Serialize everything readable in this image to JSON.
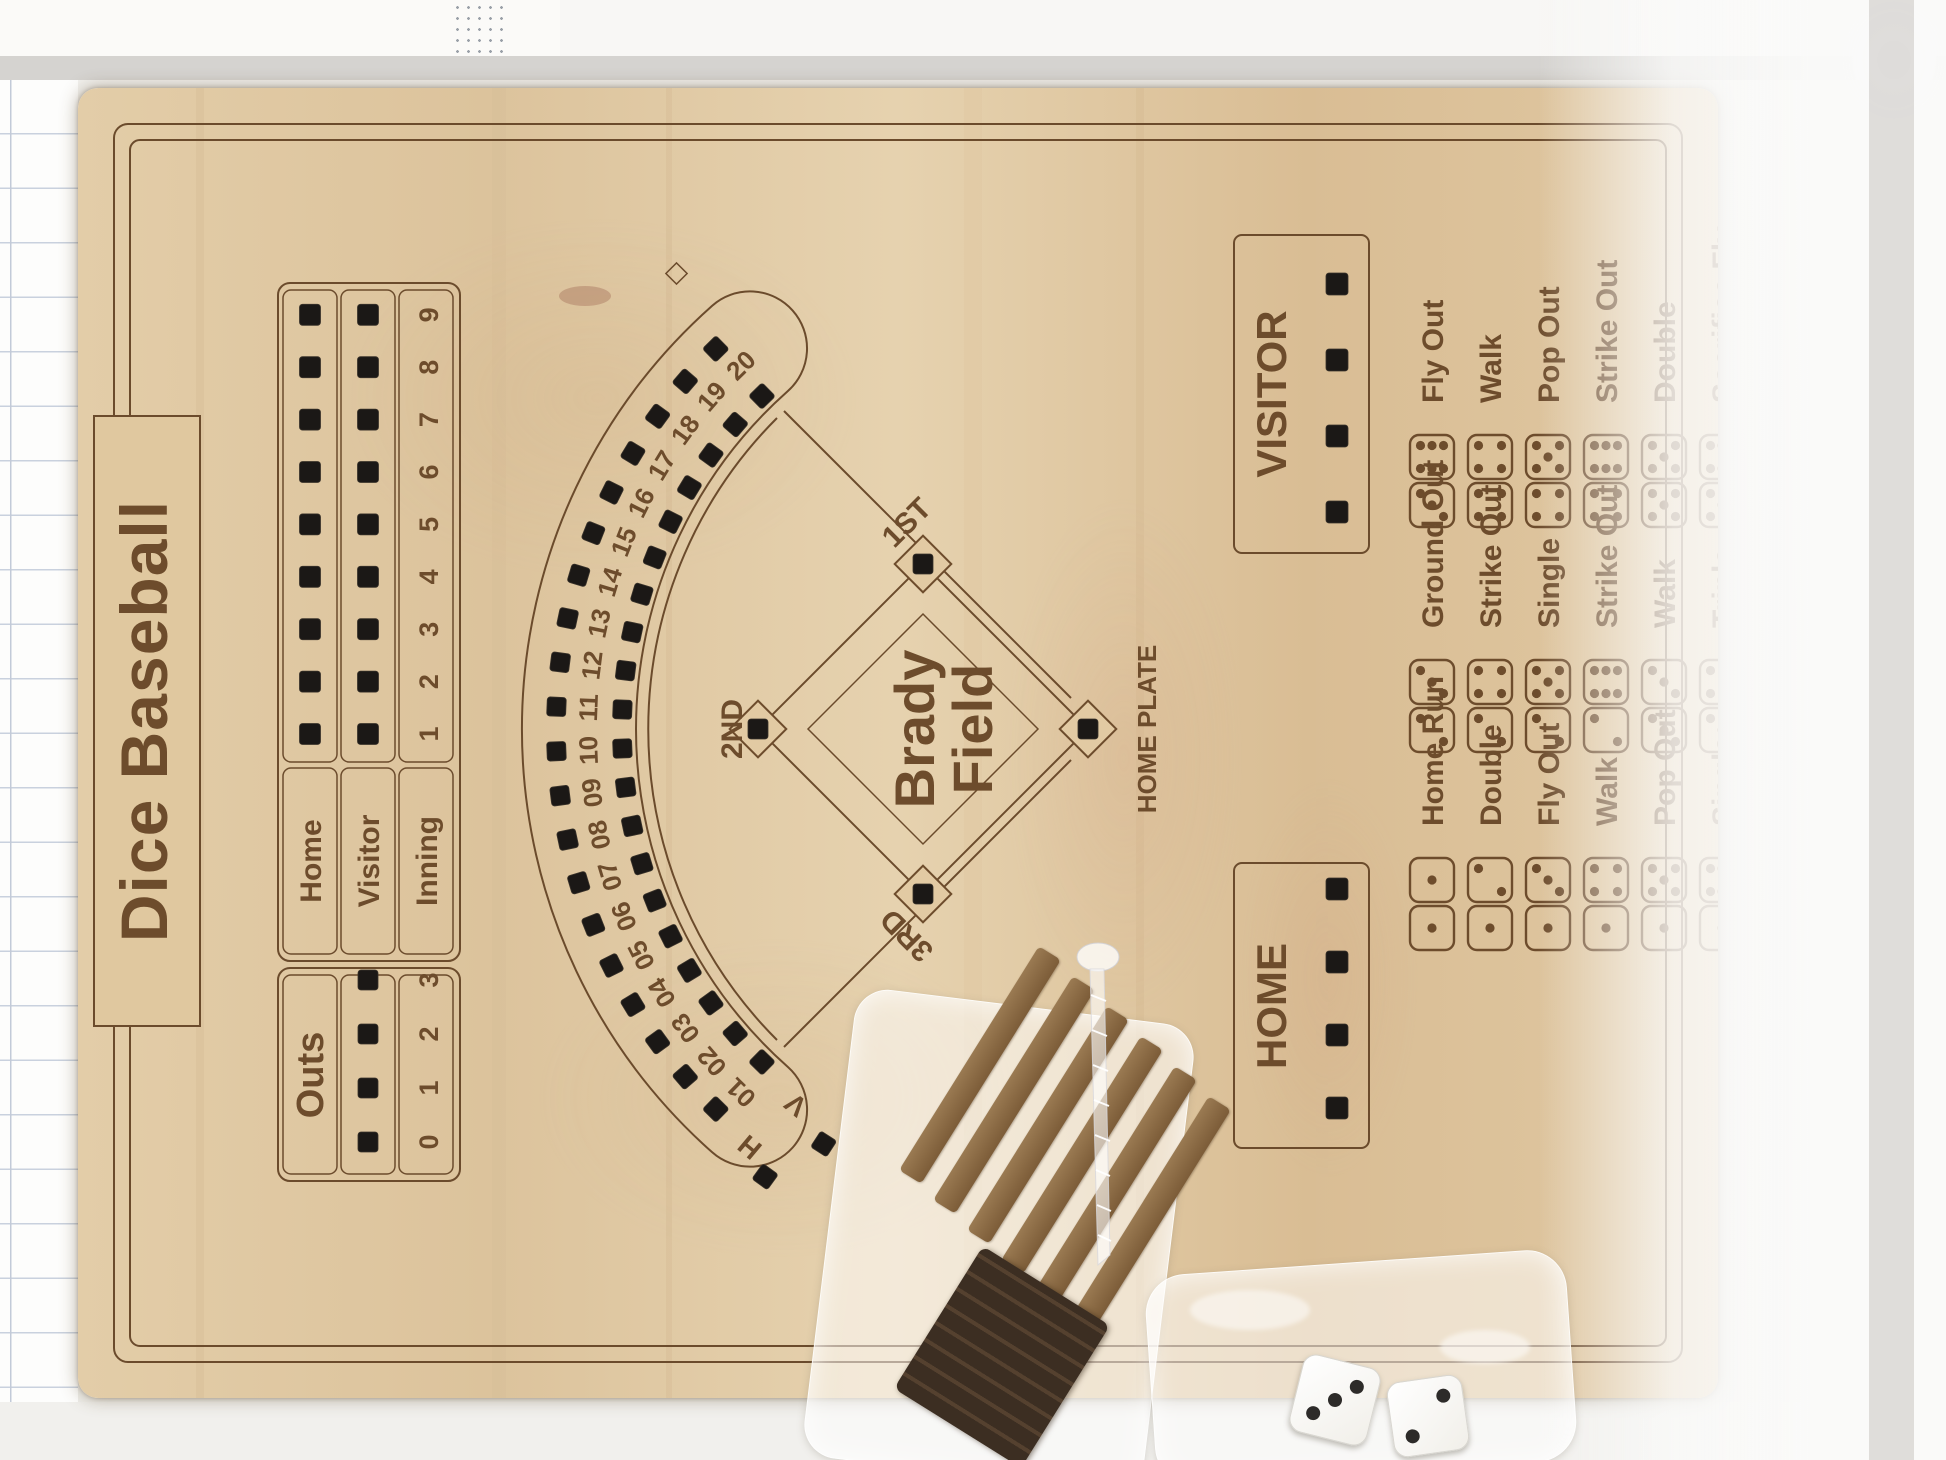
{
  "title": "Dice Baseball",
  "scoreboard": {
    "outs": {
      "label": "Outs",
      "numbers": [
        "0",
        "1",
        "2",
        "3"
      ],
      "holes": 4
    },
    "rows": [
      {
        "label": "Home",
        "holes": 9
      },
      {
        "label": "Visitor",
        "holes": 9
      },
      {
        "label": "Inning",
        "holes": 0
      }
    ],
    "innings": [
      "1",
      "2",
      "3",
      "4",
      "5",
      "6",
      "7",
      "8",
      "9"
    ]
  },
  "field": {
    "name_line1": "Brady",
    "name_line2": "Field",
    "bases": {
      "first": "1ST",
      "second": "2ND",
      "third": "3RD",
      "home": "HOME PLATE"
    }
  },
  "score_track": {
    "home_row_label": "H",
    "visitor_row_label": "V",
    "numbers": [
      "01",
      "02",
      "03",
      "04",
      "05",
      "06",
      "07",
      "08",
      "09",
      "10",
      "11",
      "12",
      "13",
      "14",
      "15",
      "16",
      "17",
      "18",
      "19",
      "20"
    ]
  },
  "team_boxes": {
    "home_label": "HOME",
    "visitor_label": "VISITOR",
    "holes_per_box": 4
  },
  "dice_chart": {
    "rows": [
      [
        {
          "dice": [
            1,
            1
          ],
          "label": "Home Run"
        },
        {
          "dice": [
            2,
            3
          ],
          "label": "Ground Out"
        },
        {
          "dice": [
            3,
            6
          ],
          "label": "Fly Out"
        }
      ],
      [
        {
          "dice": [
            1,
            2
          ],
          "label": "Double"
        },
        {
          "dice": [
            2,
            4
          ],
          "label": "Strike Out"
        },
        {
          "dice": [
            4,
            4
          ],
          "label": "Walk"
        }
      ],
      [
        {
          "dice": [
            1,
            3
          ],
          "label": "Fly Out"
        },
        {
          "dice": [
            2,
            5
          ],
          "label": "Single"
        },
        {
          "dice": [
            4,
            5
          ],
          "label": "Pop Out"
        }
      ],
      [
        {
          "dice": [
            1,
            4
          ],
          "label": "Walk"
        },
        {
          "dice": [
            2,
            6
          ],
          "label": "Strike Out"
        },
        {
          "dice": [
            4,
            6
          ],
          "label": "Strike Out"
        }
      ],
      [
        {
          "dice": [
            1,
            5
          ],
          "label": "Pop Out"
        },
        {
          "dice": [
            3,
            3
          ],
          "label": "Walk"
        },
        {
          "dice": [
            5,
            5
          ],
          "label": "Double"
        }
      ],
      [
        {
          "dice": [
            1,
            6
          ],
          "label": "Single"
        },
        {
          "dice": [
            3,
            4
          ],
          "label": "Triple"
        },
        {
          "dice": [
            5,
            6
          ],
          "label": "Sacrifice Fly"
        }
      ],
      [
        {
          "dice": [
            2,
            2
          ],
          "label": "Double Play"
        },
        {
          "dice": [
            3,
            5
          ],
          "label": "Ground Out"
        },
        {
          "dice": [
            6,
            6
          ],
          "label": "Home Run"
        }
      ]
    ]
  },
  "accessories": {
    "white_dice_faces": [
      3,
      2
    ]
  },
  "colors": {
    "engraving": "#6d4c2c",
    "engraving_light": "#7a5a38",
    "hole": "#1b1816",
    "wood": "#dfc7a1",
    "wood_dark": "#d2b288",
    "wood_light": "#e9d8b6"
  }
}
